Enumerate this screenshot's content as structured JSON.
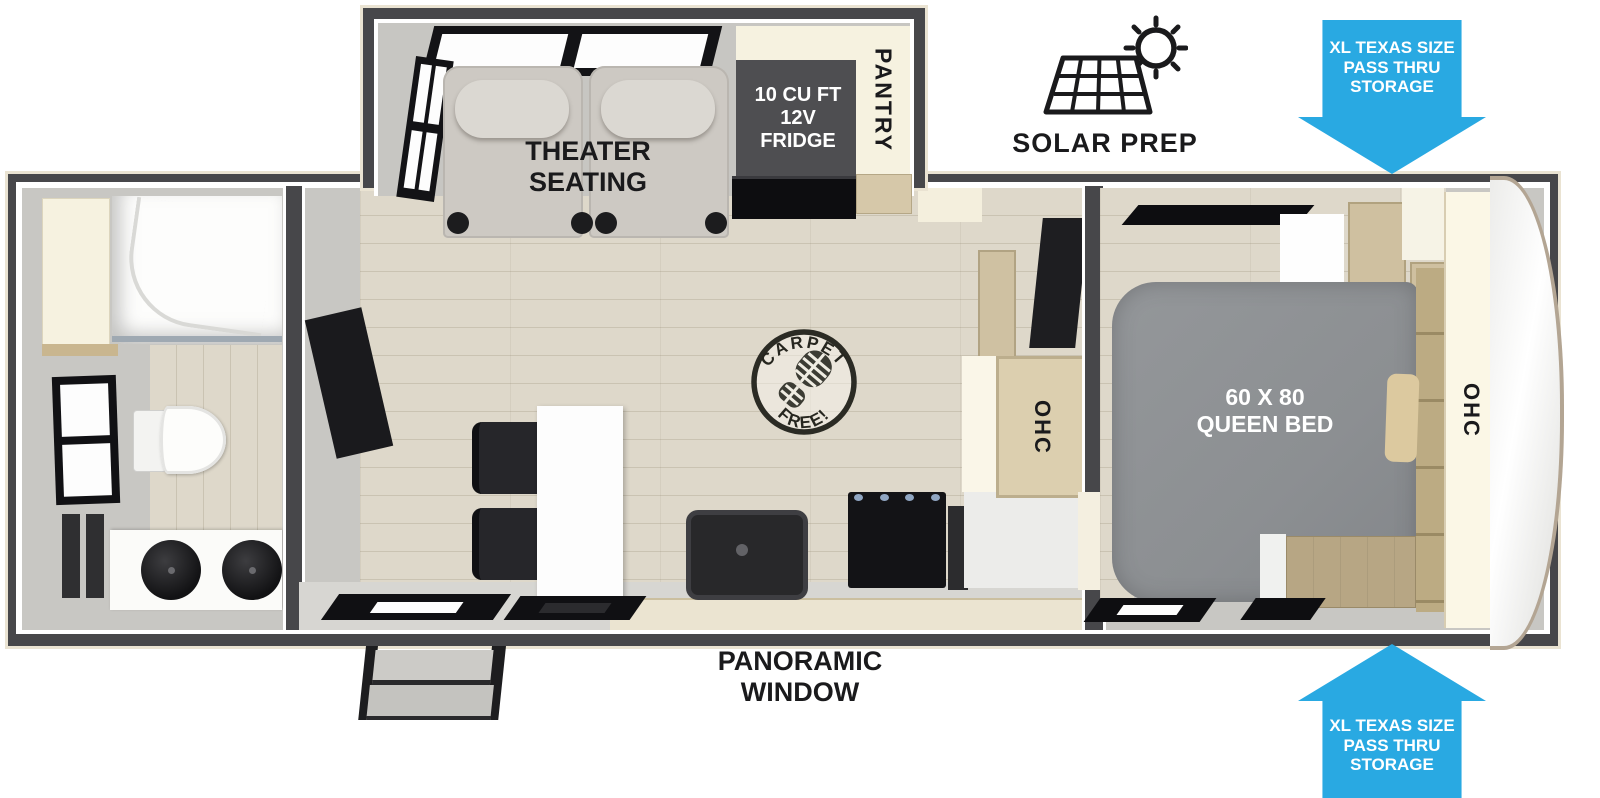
{
  "labels": {
    "theater_seating": "THEATER\nSEATING",
    "fridge": "10 CU FT\n12V\nFRIDGE",
    "pantry": "PANTRY",
    "solar_prep": "SOLAR PREP",
    "pass_thru_storage_top": "XL TEXAS SIZE\nPASS THRU\nSTORAGE",
    "pass_thru_storage_bottom": "XL TEXAS SIZE\nPASS THRU\nSTORAGE",
    "queen_bed": "60 X 80\nQUEEN BED",
    "ohc_kitchen": "OHC",
    "ohc_front_cap": "OHC",
    "carpet_free_arc_top": "CARPET",
    "carpet_free_arc_bottom": "FREE!",
    "panoramic_window": "PANORAMIC\nWINDOW"
  },
  "colors": {
    "arrow_blue": "#29a9e2",
    "wall_dark": "#47474a",
    "interior_gray": "#c8c7c3",
    "floor_wood": "#ded8ca",
    "bed_gray": "#8c8f92",
    "cabinet_cream": "#f6f2e0",
    "cabinet_tan": "#d6c8a9",
    "appliance_black": "#131316",
    "label_black": "#1a1a1c",
    "label_white": "#ffffff"
  },
  "icons": {
    "solar_prep": "solar-panel-sun-icon",
    "carpet_free": "boot-print-stamp-icon",
    "storage_arrows": "pass-thru-arrow-icon"
  }
}
